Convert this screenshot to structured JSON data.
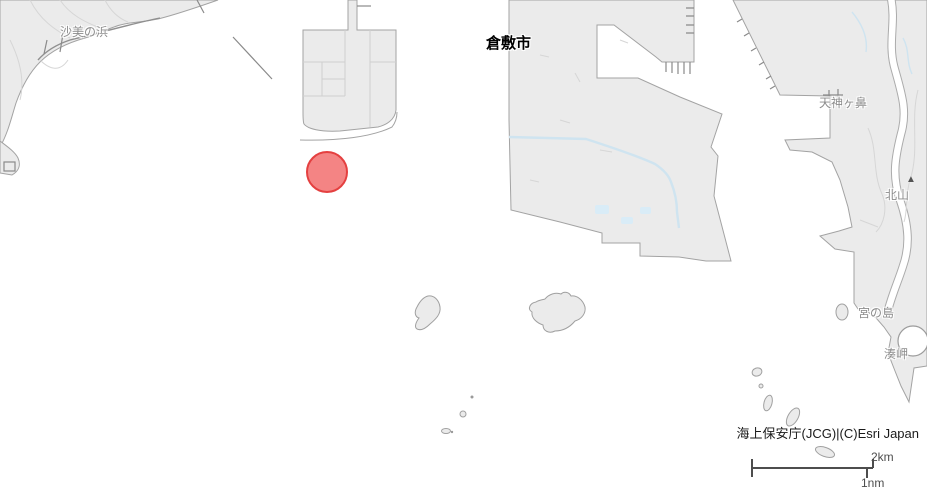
{
  "map": {
    "place_labels": {
      "city": "倉敷市",
      "beach": "沙美の浜",
      "cape_tenjin": "天神ヶ鼻",
      "mountain": "北山",
      "island_miya": "宮の島",
      "cape_minato": "湊岬"
    },
    "marker": {
      "shape": "circle",
      "x": 327,
      "y": 172,
      "radius": 21
    },
    "attribution": "海上保安庁(JCG)|(C)Esri Japan",
    "scale_bar": {
      "km": "2km",
      "nm": "1nm"
    },
    "icons": {
      "mountain_peak": "▲"
    }
  },
  "colors": {
    "water": "#ffffff",
    "land": "#ebebeb",
    "coastline": "#a3a3a3",
    "road": "#d6d6d6",
    "stream": "#cfe4f0",
    "pond": "#d9ecf7",
    "marker-fill": "#f47a7a",
    "marker-stroke": "#e23030",
    "label-gray": "#8c8c8c",
    "label-dark": "#000000",
    "scalebar": "#4d4d4d",
    "attribution-text": "#1a1a1a"
  }
}
